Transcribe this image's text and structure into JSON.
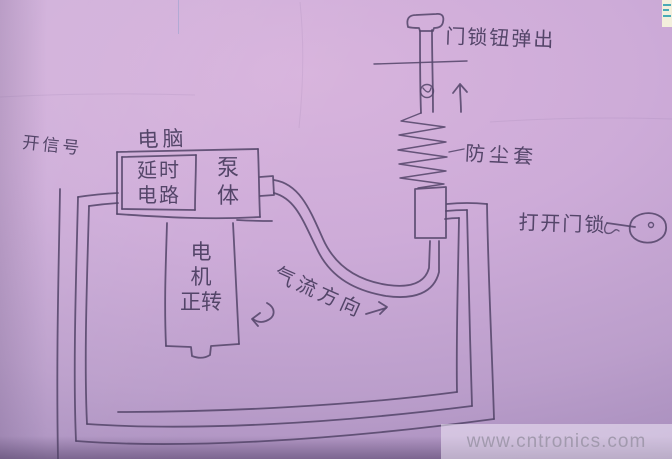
{
  "meta": {
    "width": 672,
    "height": 459,
    "description": "hand-drawn schematic of a pneumatic car door-lock actuator on lavender paper"
  },
  "colors": {
    "paper_light": "#d8b4dd",
    "paper_mid": "#cdabd8",
    "paper_dark": "#a58cbb",
    "pencil": "#55476b",
    "text": "#4a3d60",
    "watermark_text": "#a29aae",
    "artifact_teal": "#2a9daf"
  },
  "labels": {
    "lock_knob": "门锁钮弹出",
    "dust_cover": "防尘套",
    "open_lock": "打开门锁",
    "signal": "开信号",
    "computer": "电脑",
    "delay_line1": "延时",
    "delay_line2": "电路",
    "pump_line1": "泵",
    "pump_line2": "体",
    "motor_line1": "电",
    "motor_line2": "机",
    "motor_line3": "正转",
    "airflow": "气流方向"
  },
  "watermark": {
    "text": "www.cntronics.com"
  }
}
